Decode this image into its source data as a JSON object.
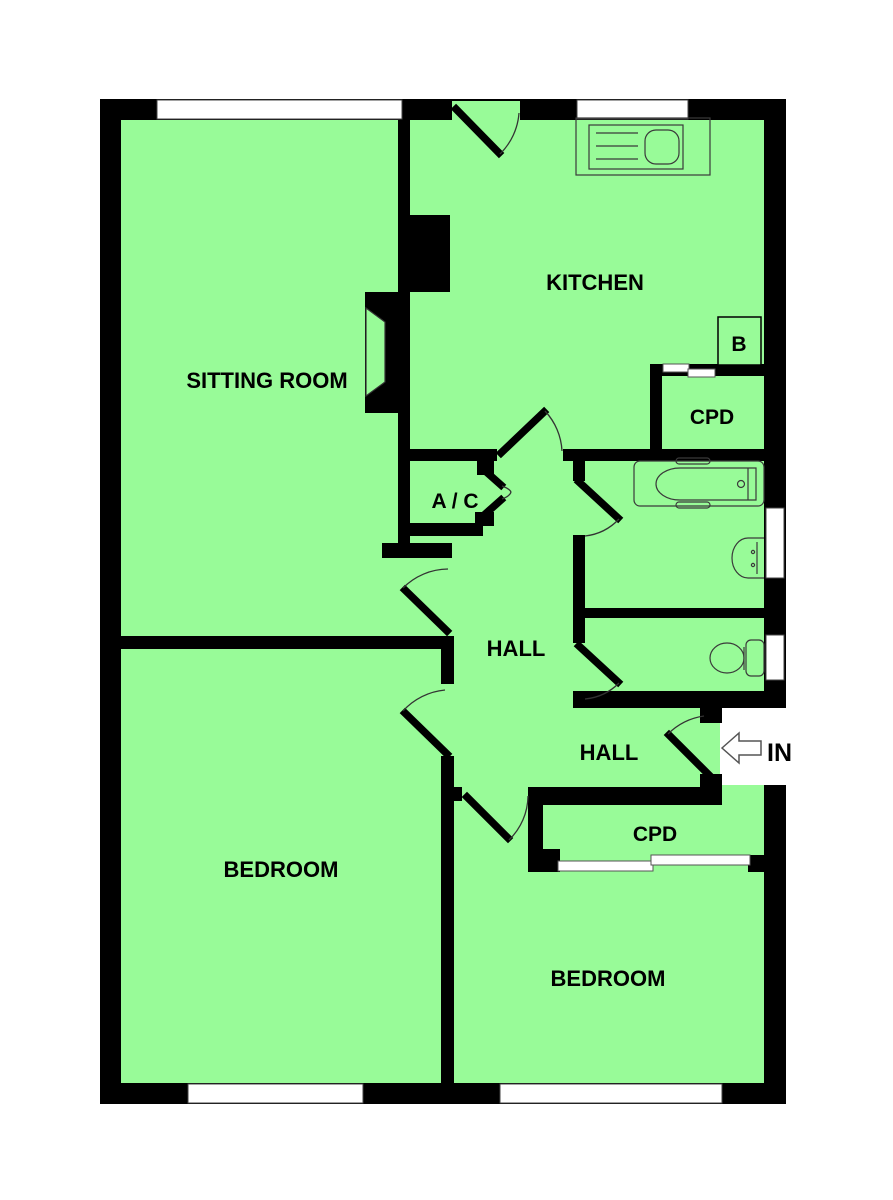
{
  "plan": {
    "type": "residential-floor-plan",
    "colors": {
      "floor": "#98FB98",
      "wall": "#000000",
      "fixture_outline": "#3a3a3a",
      "window": "#ffffff"
    },
    "labels": {
      "sitting_room": "SITTING ROOM",
      "kitchen": "KITCHEN",
      "boiler": "B",
      "cupboard_top": "CPD",
      "airing_cupboard": "A / C",
      "hall_upper": "HALL",
      "hall_lower": "HALL",
      "cupboard_bottom": "CPD",
      "bedroom_left": "BEDROOM",
      "bedroom_right": "BEDROOM",
      "entrance": "IN"
    },
    "fixtures": [
      "kitchen-sink",
      "boiler",
      "bath",
      "wash-basin",
      "toilet",
      "fireplace",
      "entry-arrow"
    ],
    "windows_count": 6,
    "rooms": [
      "SITTING ROOM",
      "KITCHEN",
      "CPD",
      "A / C",
      "HALL",
      "HALL",
      "CPD",
      "BEDROOM",
      "BEDROOM",
      "BATHROOM",
      "WC"
    ]
  }
}
